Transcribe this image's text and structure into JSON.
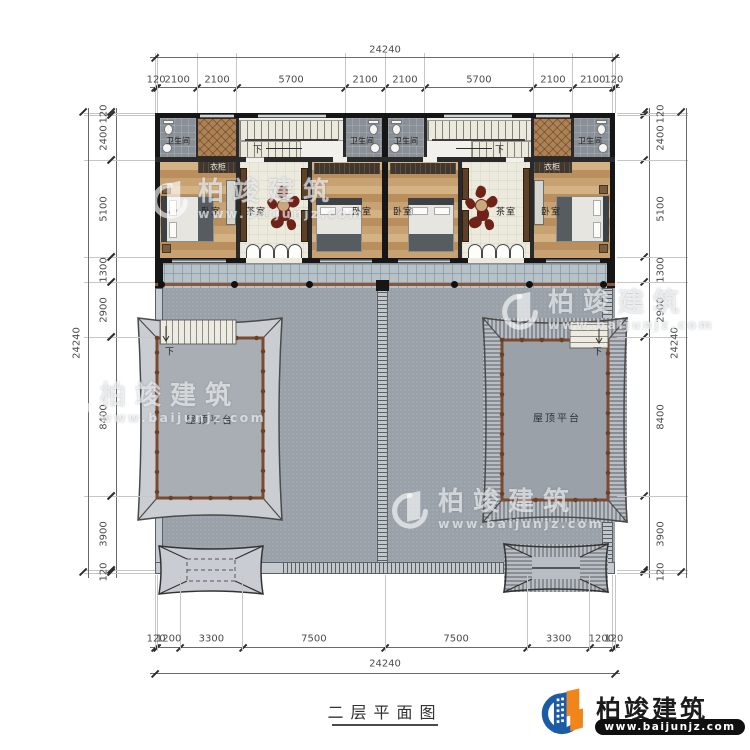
{
  "drawing": {
    "title": "二层平面图",
    "rooms": {
      "bedroom": "卧室",
      "tearoom": "茶室",
      "bathroom": "卫生间",
      "wardrobe": "衣柜",
      "roof_terrace": "屋顶平台",
      "stairs_down": "下"
    },
    "dims": {
      "overall": "24240",
      "top": [
        "120",
        "2100",
        "2100",
        "5700",
        "2100",
        "2100",
        "5700",
        "2100",
        "2100",
        "120"
      ],
      "bottom": [
        "120",
        "1200",
        "3300",
        "7500",
        "7500",
        "3300",
        "1200",
        "120"
      ],
      "left": [
        "120",
        "2400",
        "5100",
        "1300",
        "2900",
        "8400",
        "3900",
        "120"
      ],
      "right": [
        "120",
        "2400",
        "5100",
        "1300",
        "2900",
        "8400",
        "3900",
        "120"
      ]
    }
  },
  "watermark": {
    "name": "柏竣建筑",
    "url": "www.baijunjz.com"
  },
  "footer": {
    "brand": "柏竣建筑",
    "url": "www.baijunjz.com",
    "colors": {
      "blue": "#1c5ba5",
      "orange": "#f08519",
      "bar": "#101010",
      "text": "#1c1c1c"
    }
  }
}
